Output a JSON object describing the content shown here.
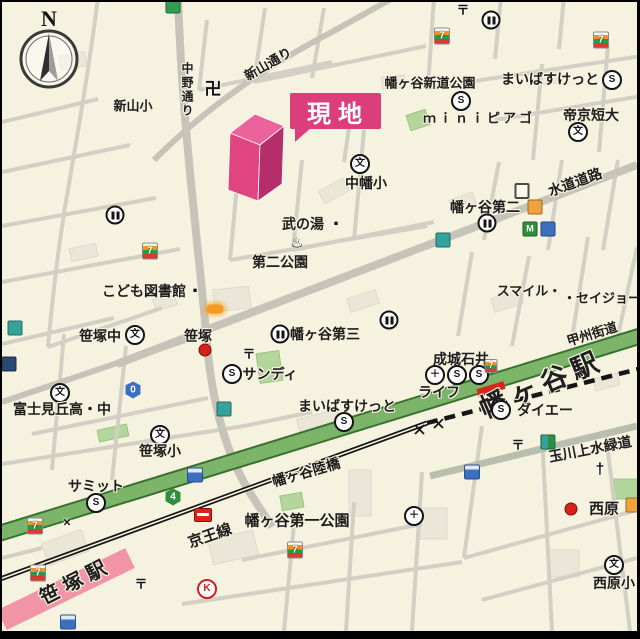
{
  "map_title": "周辺地図(現地案内図)",
  "site": {
    "marker_label": "現地"
  },
  "labels": {
    "compass_n": "N",
    "shinyama_sho": "新山小",
    "nakano_dori": "中野通り",
    "manji": "卍",
    "shinyama_dori": "新山通り",
    "hatagaya_shindo_koen": "幡ヶ谷新道公園",
    "maibasuketto_1": "まいばすけっと",
    "mini_piago": "ｍｉｎｉピアゴ",
    "teikyo_tandai": "帝京短大",
    "nakahata_sho": "中幡小",
    "hatagaya_daini": "幡ヶ谷第二",
    "suido_doro": "水道道路",
    "smile": "スマイル・",
    "seijo": "・セイジョー",
    "take_no_yu": "武の湯",
    "daini_koen": "第二公園",
    "kodomo_toshokan": "こども図書館",
    "sasazuka_chu": "笹塚中",
    "sasazuka": "笹塚",
    "sandy": "サンディ",
    "hatagaya_daisan": "幡ヶ谷第三",
    "seijo_ishii": "成城石井",
    "life": "ライフ",
    "hatagaya_eki": "幡ヶ谷駅",
    "daiei": "ダイエー",
    "koshu_kaido": "甲州街道",
    "maibasuketto_2": "まいばすけっと",
    "fujimigaoka": "富士見丘高・中",
    "sasazuka_sho": "笹塚小",
    "summit": "サミット",
    "hatagaya_rikkyo": "幡ヶ谷陸橋",
    "hatagaya_daiichi_koen": "幡ヶ谷第一公園",
    "keio_line": "京王線",
    "sasazuka_eki": "笹塚駅",
    "tamagawa_josui": "玉川上水緑道",
    "nishihara": "西原",
    "nishihara_sho": "西原小"
  },
  "glyphs": {
    "super": "S",
    "school": "文",
    "post": "〒",
    "hospital": "＋",
    "temple": "卍",
    "church": "†",
    "onsen": "♨",
    "police_x": "×",
    "kentucky": "K",
    "seven": "7",
    "route_0": "0",
    "route_4": "4",
    "dot": "■"
  },
  "colors": {
    "site_pink": "#dc3e7c",
    "marker_top": "#ea639a",
    "marker_front": "#e0457f",
    "marker_side": "#b52d6a",
    "koshu_green": "#7cb569",
    "rail_black": "#161616",
    "sasazuka_station_band": "#f094a6",
    "station_red": "#d9251d",
    "background_cream": "#f6f2e0",
    "road_gray": "#c6c3b9"
  }
}
